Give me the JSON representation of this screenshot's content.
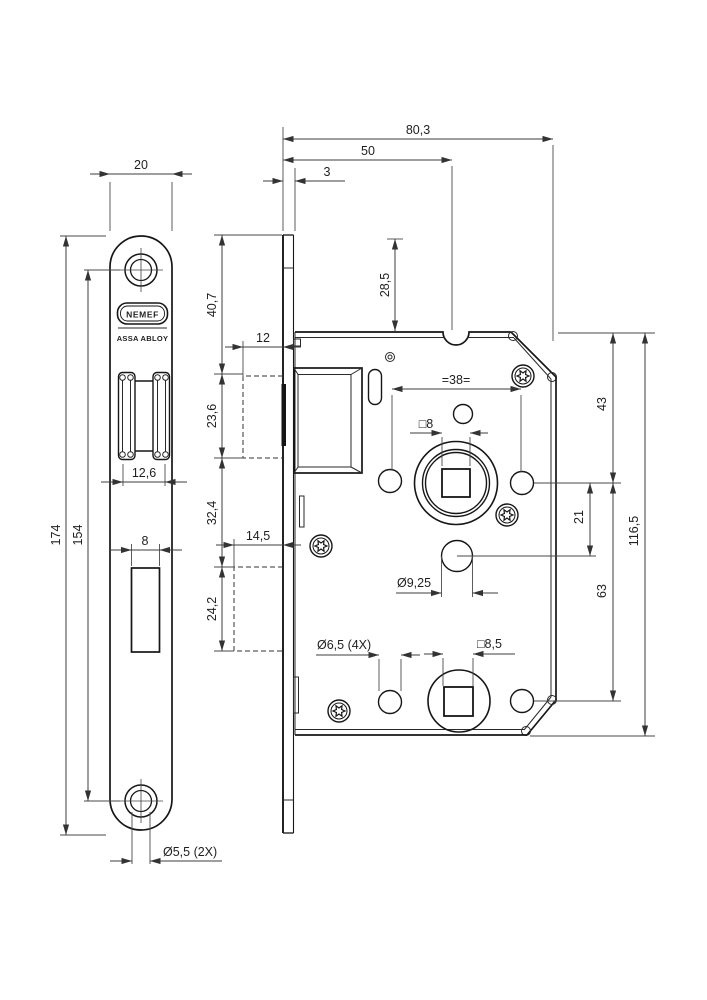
{
  "drawing": {
    "brand": {
      "logo_text": "NEMEF",
      "sub_text": "ASSA ABLOY"
    },
    "front_view": {
      "plate_width": "20",
      "plate_length": "174",
      "hole_spacing": "154",
      "latch_cutout_width": "12,6",
      "deadbolt_cutout_width": "8",
      "screw_holes": "Ø5,5 (2X)"
    },
    "side_view": {
      "overall_depth": "80,3",
      "backset": "50",
      "faceplate_thickness": "3",
      "top_to_case": "28,5",
      "top_to_latch": "40,7",
      "latch_cutout_height": "23,6",
      "latch_to_deadbolt": "32,4",
      "deadbolt_cutout_height": "24,2",
      "latch_cutout_depth": "12",
      "deadbolt_cutout_depth": "14,5",
      "screw_hole_spacing": "=38=",
      "follower_square": "□8",
      "case_top_to_follower": "43",
      "follower_to_cylinder": "21",
      "follower_to_lower_follower": "63",
      "case_height": "116,5",
      "cylinder_hole_dia": "Ø9,25",
      "fixing_holes_dia": "Ø6,5 (4X)",
      "lower_follower_square": "□8,5"
    }
  }
}
